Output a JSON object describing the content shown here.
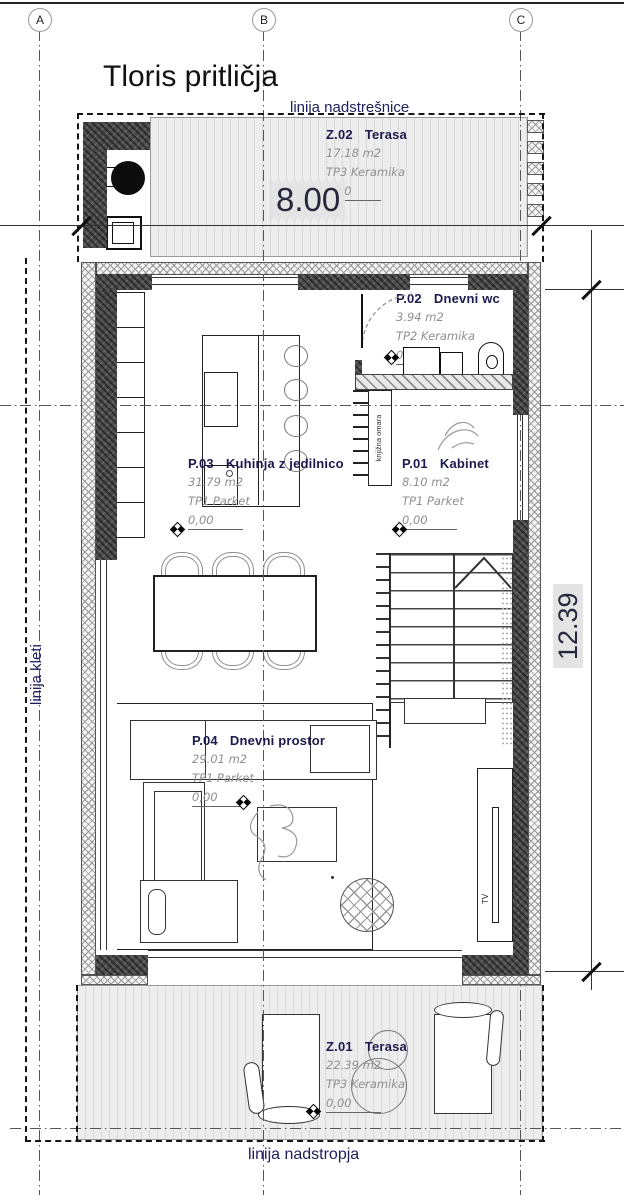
{
  "title": "Tloris pritličja",
  "grid": {
    "a": "A",
    "b": "B",
    "c": "C"
  },
  "lines": {
    "canopy": "linija nadstrešnice",
    "basement": "linija kleti",
    "upper": "linija nadstropja"
  },
  "dims": {
    "width": "8.00",
    "height": "12.39"
  },
  "rooms": [
    {
      "id": "Z.02",
      "name": "Terasa",
      "area": "17.18 m2",
      "finish": "TP3 Keramika",
      "level": "0,00"
    },
    {
      "id": "P.02",
      "name": "Dnevni wc",
      "area": "3.94 m2",
      "finish": "TP2 Keramika",
      "level": "0,00"
    },
    {
      "id": "P.03",
      "name": "Kuhinja z jedilnico",
      "area": "31.79 m2",
      "finish": "TP1 Parket",
      "level": "0,00"
    },
    {
      "id": "P.01",
      "name": "Kabinet",
      "area": "8.10 m2",
      "finish": "TP1 Parket",
      "level": "0,00"
    },
    {
      "id": "P.04",
      "name": "Dnevni prostor",
      "area": "29.01 m2",
      "finish": "TP1 Parket",
      "level": "0,00"
    },
    {
      "id": "Z.01",
      "name": "Terasa",
      "area": "22.39 m2",
      "finish": "TP3 Keramika",
      "level": "0,00"
    }
  ],
  "annotations": {
    "bookshelf": "knjižna omara",
    "tv": "TV"
  },
  "colors": {
    "wall": "#4e4e4e",
    "label": "#1a1a4e",
    "dim_bg": "#e4e4e4"
  }
}
